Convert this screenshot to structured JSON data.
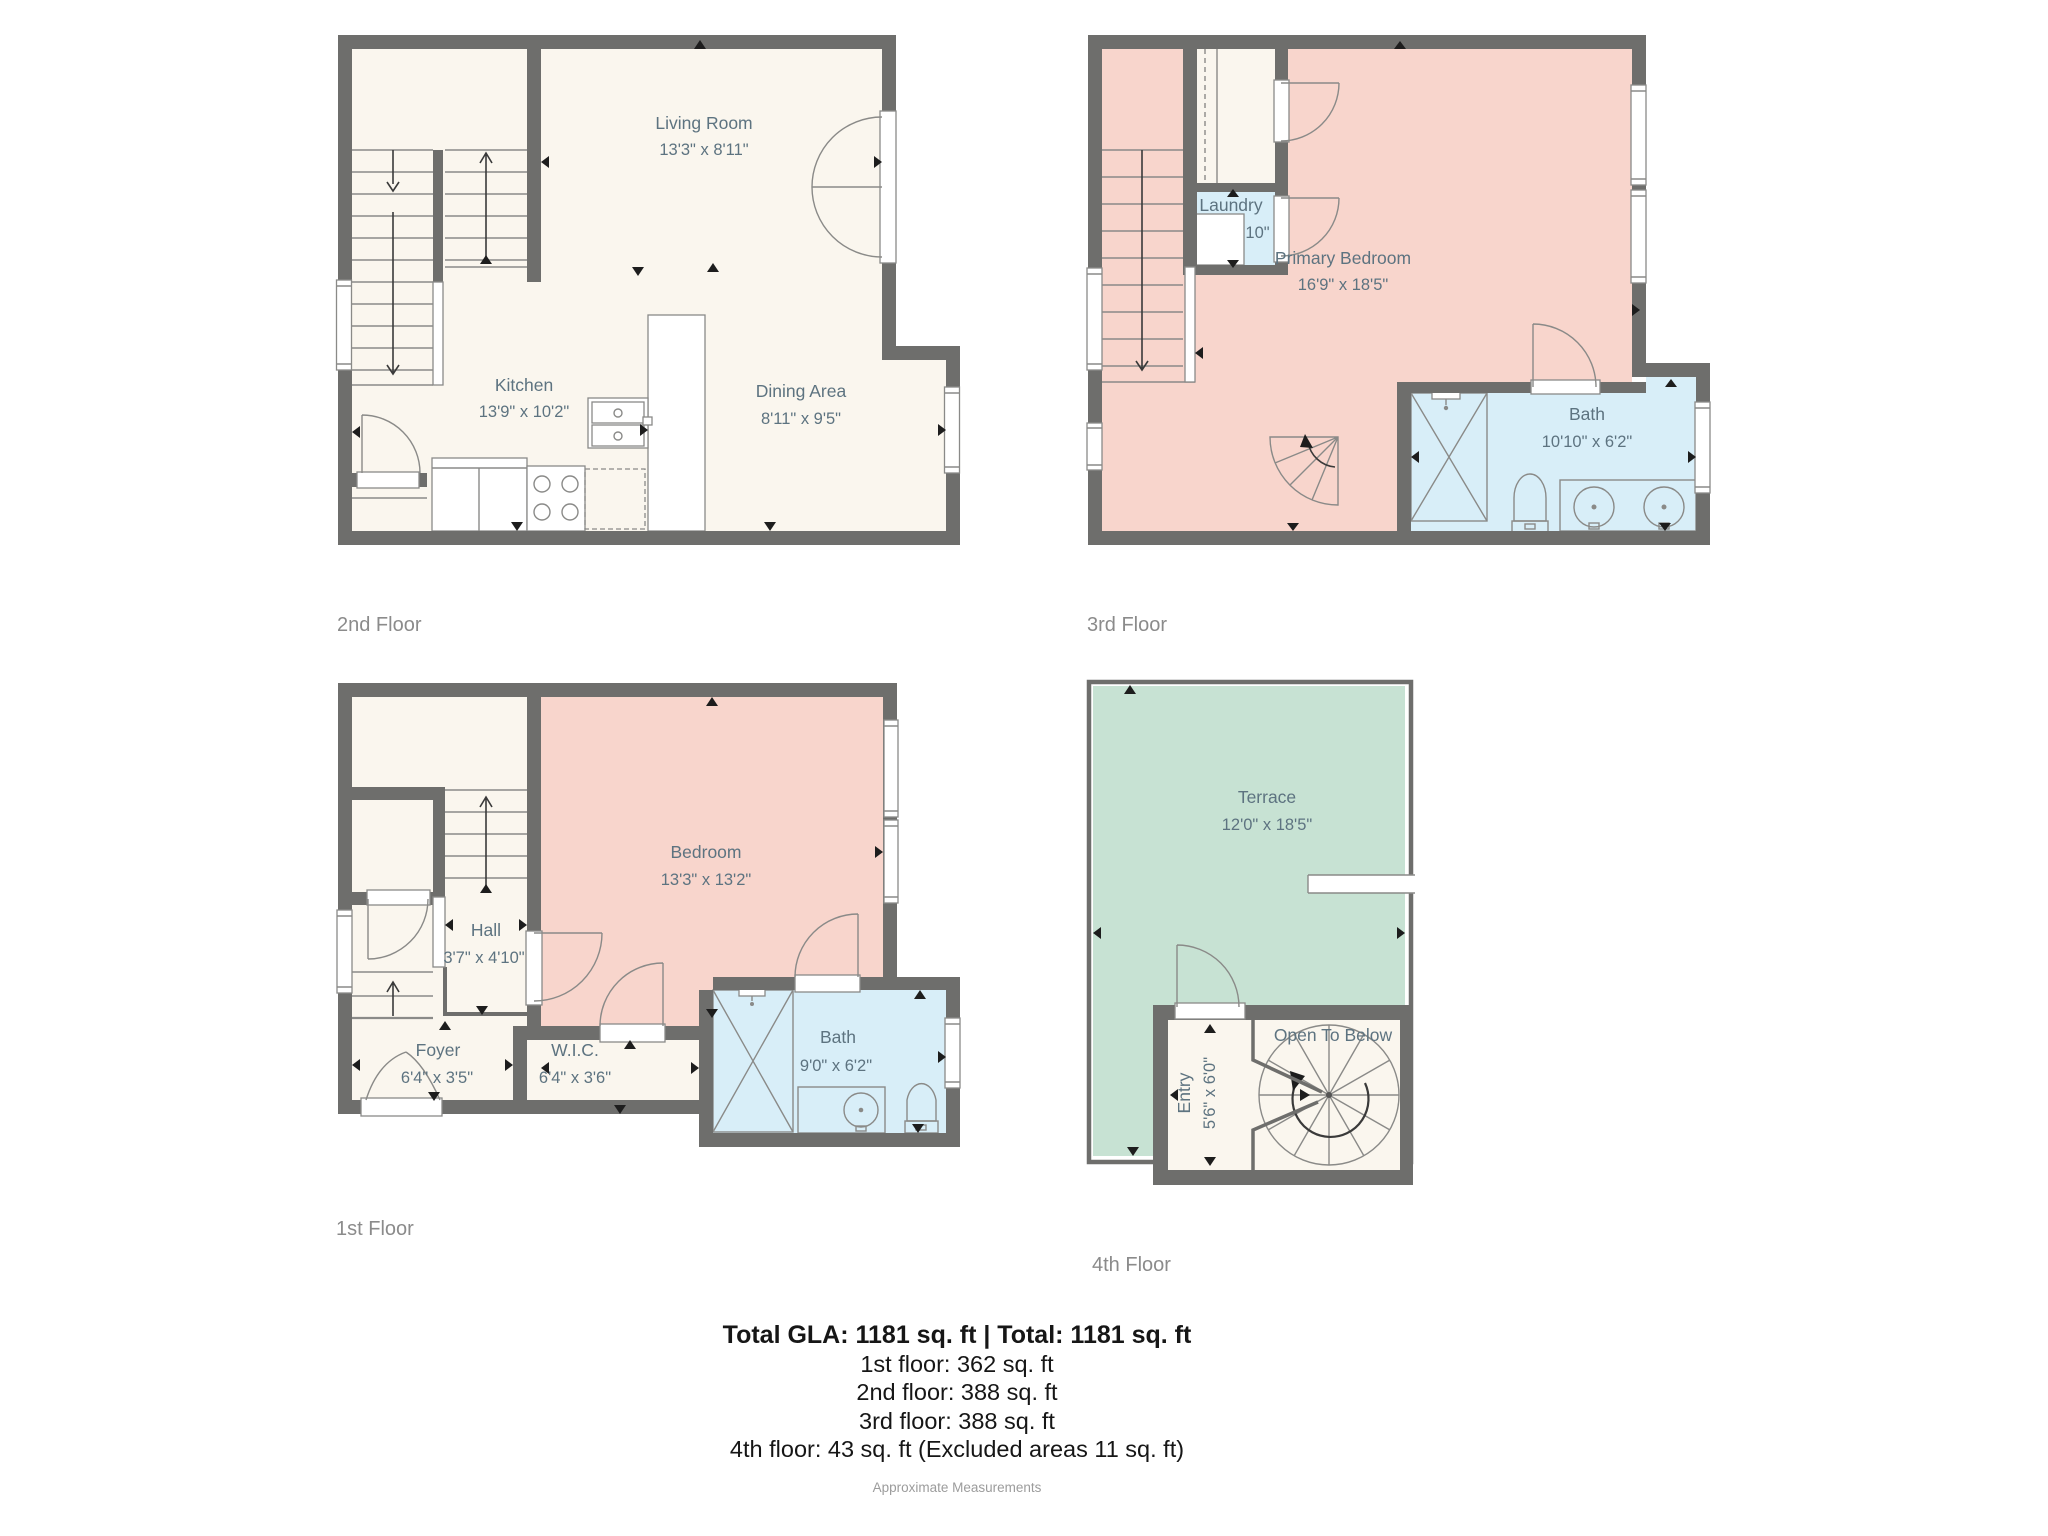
{
  "colors": {
    "wall": "#6e6e6c",
    "room_default": "#faf6ee",
    "bedroom_pink": "#f8d5cc",
    "bath_blue": "#d8eef8",
    "terrace_green": "#c7e2d3",
    "fixture_line": "#8a8a88",
    "room_label_text": "#5d7380",
    "floor_label_text": "#8b8b8b",
    "footer_text": "#161616",
    "footer_note_text": "#9c9c9c"
  },
  "floor_2": {
    "label": "2nd Floor",
    "rooms": {
      "living_room": {
        "name": "Living Room",
        "dims": "13'3\" x 8'11\""
      },
      "kitchen": {
        "name": "Kitchen",
        "dims": "13'9\" x 10'2\""
      },
      "dining_area": {
        "name": "Dining Area",
        "dims": "8'11\" x 9'5\""
      }
    }
  },
  "floor_3": {
    "label": "3rd Floor",
    "rooms": {
      "laundry": {
        "name": "Laundry",
        "dims": "3'2\" x 2'10\""
      },
      "primary_bedroom": {
        "name": "Primary Bedroom",
        "dims": "16'9\" x 18'5\""
      },
      "bath": {
        "name": "Bath",
        "dims": "10'10\" x 6'2\""
      }
    }
  },
  "floor_1": {
    "label": "1st Floor",
    "rooms": {
      "hall": {
        "name": "Hall",
        "dims": "3'7\" x 4'10\""
      },
      "bedroom": {
        "name": "Bedroom",
        "dims": "13'3\" x 13'2\""
      },
      "foyer": {
        "name": "Foyer",
        "dims": "6'4\" x 3'5\""
      },
      "wic": {
        "name": "W.I.C.",
        "dims": "6'4\" x 3'6\""
      },
      "bath": {
        "name": "Bath",
        "dims": "9'0\" x 6'2\""
      }
    }
  },
  "floor_4": {
    "label": "4th Floor",
    "rooms": {
      "terrace": {
        "name": "Terrace",
        "dims": "12'0\" x 18'5\""
      },
      "entry": {
        "name": "Entry",
        "dims": "5'6\" x 6'0\""
      },
      "open_to_below": {
        "name": "Open To Below"
      }
    }
  },
  "footer": {
    "title": "Total GLA: 1181 sq. ft | Total: 1181 sq. ft",
    "lines": [
      "1st floor: 362 sq. ft",
      "2nd floor: 388 sq. ft",
      "3rd floor: 388 sq. ft",
      "4th floor: 43 sq. ft (Excluded areas 11 sq. ft)"
    ],
    "note": "Approximate Measurements"
  }
}
